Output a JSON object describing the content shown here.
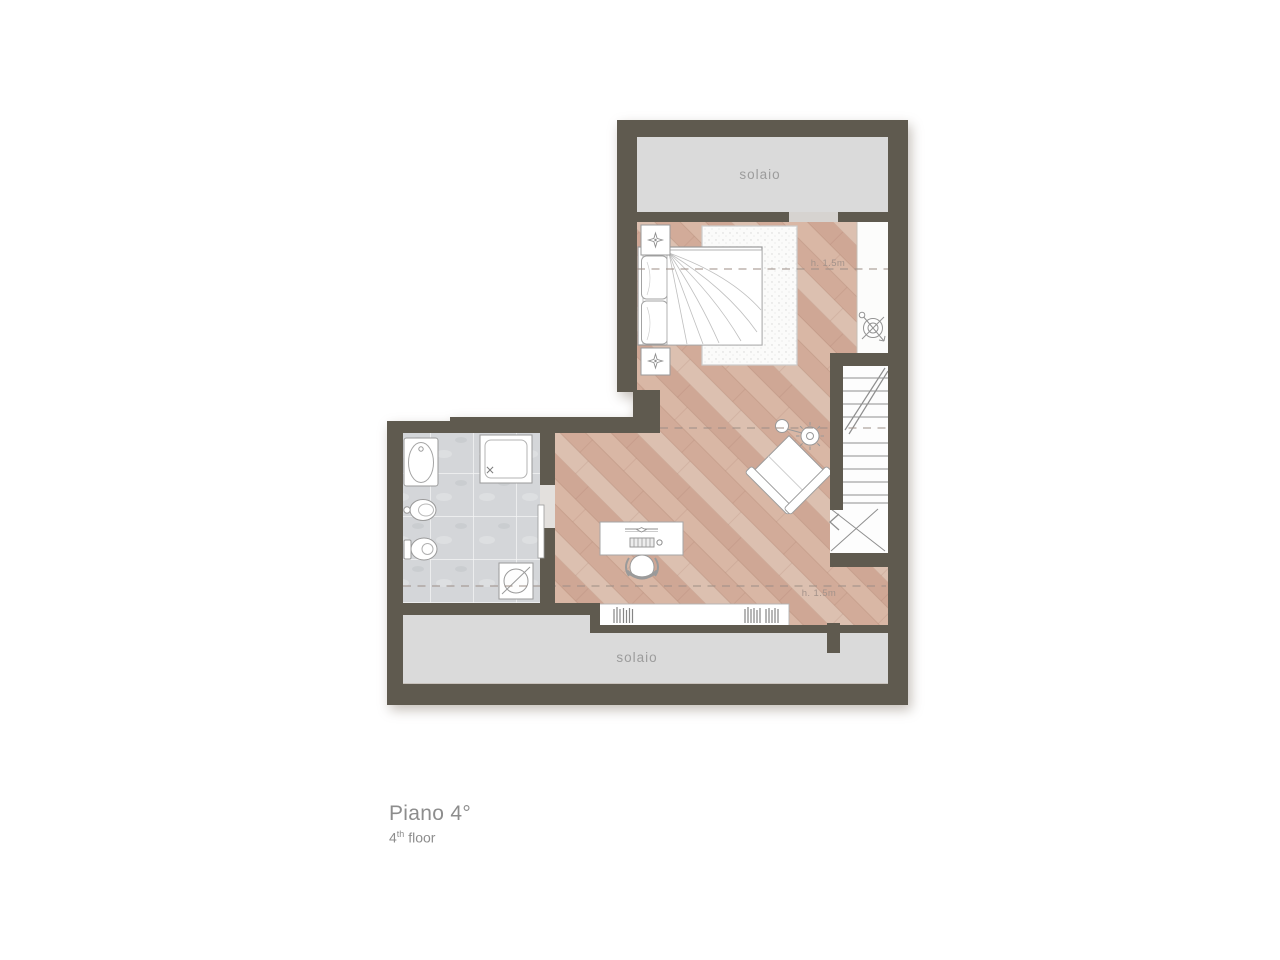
{
  "palette": {
    "wall": "#5f5a4f",
    "solaio": "#dadada",
    "threshold": "#d6d3d0",
    "wood_base": "#d8b4a2",
    "tile": "#d4d6d9",
    "furniture_outline": "#9a9a9a",
    "dash_line": "#9c8e86",
    "label_gray": "#9c9c9c",
    "caption_gray": "#8d8d8d"
  },
  "labels": {
    "solaio_top": "solaio",
    "solaio_bottom": "solaio",
    "height_upper": "h. 1.5m",
    "height_lower": "h. 1.5m"
  },
  "caption": {
    "title": "Piano 4°",
    "floor_number": "4",
    "floor_ordinal": "th",
    "floor_word": " floor"
  }
}
